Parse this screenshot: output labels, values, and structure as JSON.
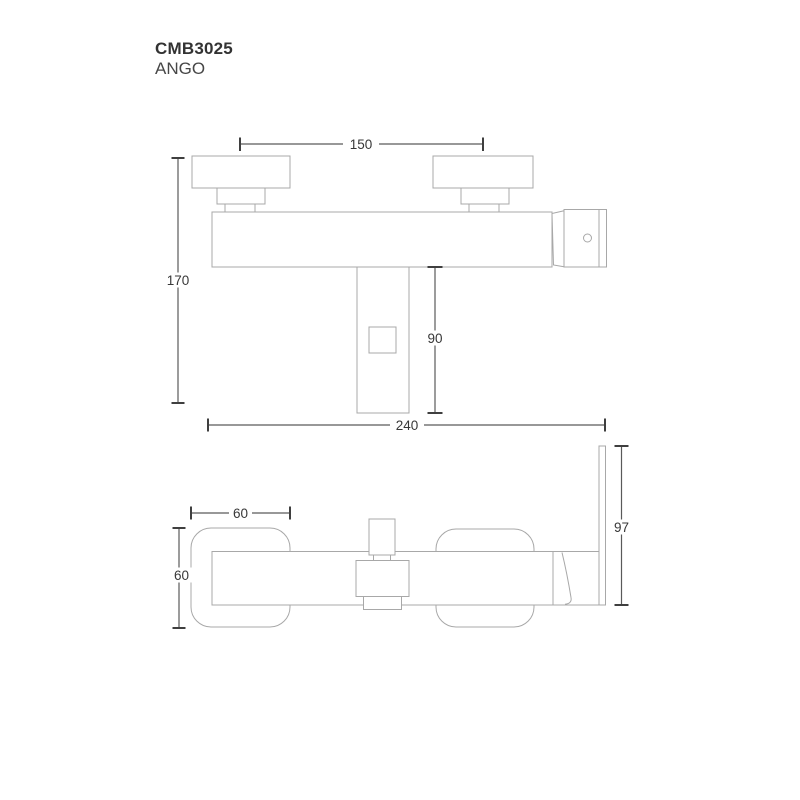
{
  "title": {
    "product_code": "CMB3025",
    "product_name": "ANGO"
  },
  "colors": {
    "background": "#ffffff",
    "outline": "#a8a8a8",
    "dimension_line": "#5a5a5a",
    "tick": "#3f3f3f",
    "label_text": "#383838",
    "title_text": "#333333"
  },
  "front_view": {
    "description": "front elevation of wall-mounted bath mixer",
    "dimensions": {
      "handle_centers": "150",
      "total_height": "170",
      "spout_drop": "90",
      "total_width": "240"
    }
  },
  "plan_view": {
    "description": "top plan view of wall-mounted bath mixer",
    "dimensions": {
      "escutcheon_width": "60",
      "escutcheon_depth": "60",
      "handle_reach": "97"
    }
  }
}
